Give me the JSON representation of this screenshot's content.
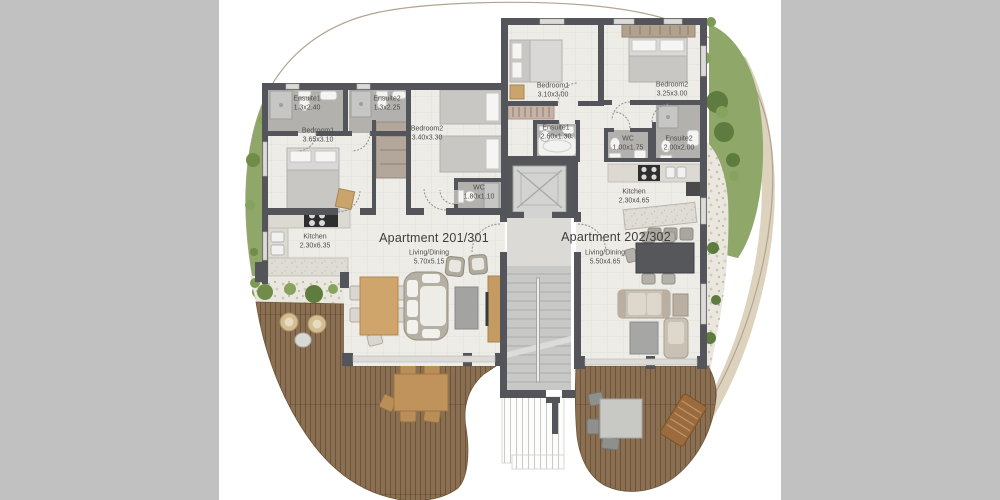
{
  "canvas": {
    "bg_outer": "#c1c1c1",
    "bg_content": "#ffffff"
  },
  "palette": {
    "wall": "#54555a",
    "floor_tile": "#edece7",
    "bath_floor": "#b2b1ae",
    "deck_wood": "#8a6f52",
    "grass": "#8fa768",
    "gravel": "#eae7df",
    "counter": "#dedcd4",
    "wood_furniture": "#d0a56c",
    "label_text": "#4d4d4b"
  },
  "apt1": {
    "title": "Apartment 201/301",
    "living": {
      "name": "Living/Dining",
      "dims": "5.70x5.15"
    },
    "ensuite1": {
      "name": "Ensuite1",
      "dims": "1.3x2.40"
    },
    "ensuite2": {
      "name": "Ensuite2",
      "dims": "1.3x2.25"
    },
    "bedroom1": {
      "name": "Bedroom1",
      "dims": "3.65x3.10"
    },
    "bedroom2": {
      "name": "Bedroom2",
      "dims": "3.40x3.30"
    },
    "wc": {
      "name": "WC",
      "dims": "1.80x1.10"
    },
    "kitchen": {
      "name": "Kitchen",
      "dims": "2.30x6.35"
    }
  },
  "apt2": {
    "title": "Apartment 202/302",
    "living": {
      "name": "Living/Dining",
      "dims": "5.50x4.65"
    },
    "bedroom1": {
      "name": "Bedroom1",
      "dims": "3.10x3.00"
    },
    "bedroom2": {
      "name": "Bedroom2",
      "dims": "3.25x3.00"
    },
    "ensuite1": {
      "name": "Ensuite1",
      "dims": "2.60x1.30"
    },
    "wc": {
      "name": "WC",
      "dims": "1.00x1.75"
    },
    "ensuite2": {
      "name": "Ensuite2",
      "dims": "2.00x2.00"
    },
    "kitchen": {
      "name": "Kitchen",
      "dims": "2.30x4.65"
    }
  }
}
